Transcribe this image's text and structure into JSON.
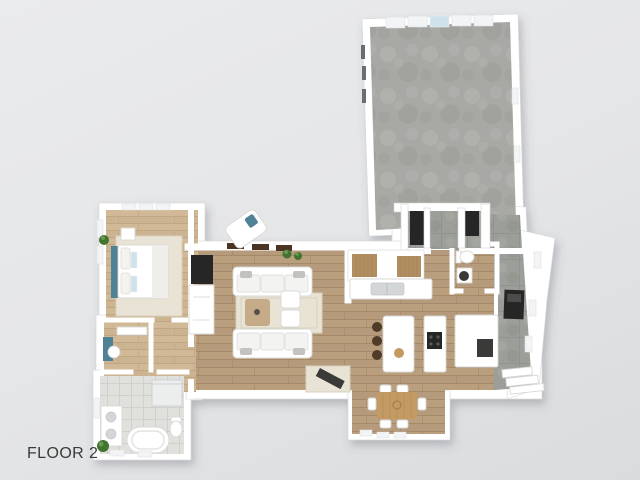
{
  "page": {
    "label": "FLOOR 2"
  },
  "palette": {
    "bg_top": "#eaebec",
    "bg_mid": "#e4e5e7",
    "bg_bottom": "#d9dbdd",
    "label": "#3b3b3b",
    "wall": "#ffffff",
    "wall_edge": "#d5d6d7",
    "wood": "#b59a7c",
    "wood_dark": "#a18463",
    "wood_light": "#c6ab88",
    "bed_wood": "#ccb391",
    "bed_wood_dark": "#bca17d",
    "carpet": "#a8a9a5",
    "carpet_light": "#b6b7b3",
    "carpet_dark": "#9a9b97",
    "tile": "#9c9e99",
    "tile_dark": "#8d8f8a",
    "bath_tile": "#e0e0dd",
    "bath_tile_line": "#cfcfcc",
    "rug": "#e9e3d6",
    "rug_dark": "#d8d1bf",
    "teal": "#4e8294",
    "plant": "#41742f",
    "dark": "#262626",
    "dark_soft": "#3a3a38",
    "stair_wood": "#b28e5e",
    "table_wood": "#c49a62",
    "stool": "#4e3b28",
    "window_blue": "#cfe2ec",
    "window_frame": "#4a3424"
  },
  "floorplan": {
    "floor_number": "2",
    "rooms": [
      "bonus-room",
      "living-room",
      "kitchen",
      "dining-area",
      "bedroom",
      "closet",
      "hallway",
      "bathroom",
      "powder-room",
      "mudroom",
      "staircase"
    ],
    "furniture": {
      "bedroom": [
        "bed",
        "teal-headboard",
        "pillows",
        "nightstand",
        "plant",
        "corner-chaise",
        "area-rug"
      ],
      "living_room": [
        "tv-wall-unit",
        "sofa-top",
        "sofa-bottom",
        "armchair-1",
        "armchair-2",
        "coffee-table",
        "area-rug",
        "entry-rug",
        "bench",
        "plants"
      ],
      "kitchen": [
        "sink-counter",
        "island",
        "bar-stools",
        "fruit-bowl",
        "cooktop-counter",
        "refrigerator-counter",
        "double-staircase"
      ],
      "dining_area": [
        "dining-table",
        "dining-chairs",
        "pendant-light"
      ],
      "bathroom": [
        "freestanding-tub",
        "vanity",
        "shower",
        "toilet",
        "plant"
      ],
      "powder_room": [
        "toilet",
        "vessel-sink"
      ],
      "mudroom": [
        "storage-closets",
        "fireplace",
        "exterior-steps"
      ],
      "closet": [
        "teal-cabinet",
        "chair"
      ]
    }
  }
}
